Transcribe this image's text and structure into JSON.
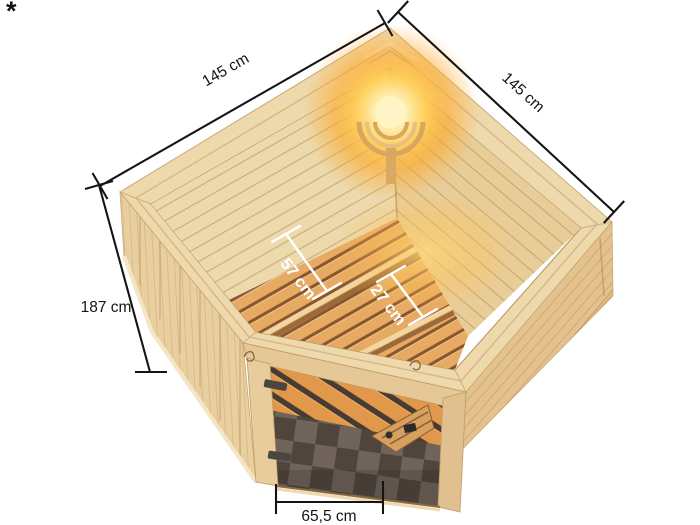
{
  "scene": {
    "background_color": "#ffffff",
    "footnote_marker": "*",
    "sauna": {
      "description": "corner sauna shown from above with front glass door",
      "colors": {
        "roof_rim": "#eed9ad",
        "exterior_wall": "#e9cf9f",
        "interior_wall_left": "#ecd9ac",
        "interior_wall_right": "#e8cd99",
        "bench_slat": "#e7aa63",
        "bench_gap": "#8a5630",
        "door_frame": "#e6c896",
        "glass_floor_light": "#70635a",
        "glass_floor_dark": "#4f453d",
        "glass_reflection": "#e2984a",
        "lamp_glow": "#ffa51f",
        "fittings": "#4a4742"
      }
    },
    "dimensions": {
      "width_left": "145 cm",
      "width_right": "145 cm",
      "height_left": "187 cm",
      "bench_upper_depth": "57 cm",
      "bench_lower_depth": "27 cm",
      "door_width": "65,5 cm"
    },
    "dimension_line_color": "#141414",
    "dimension_text_color_light": "#ffffff"
  }
}
